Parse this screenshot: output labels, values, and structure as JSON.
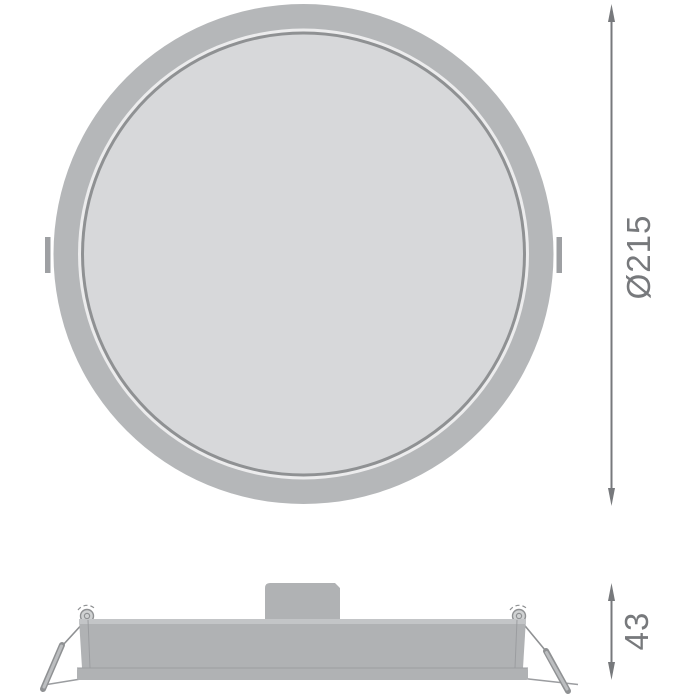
{
  "drawing": {
    "dimensions": {
      "diameter": {
        "label": "Ø215"
      },
      "height": {
        "label": "43"
      }
    }
  },
  "colors": {
    "background": "#ffffff",
    "bezel": "#b5b7b9",
    "gap_ring": "#ececed",
    "dark_ring": "#8f9193",
    "inner_face": "#d7d8da",
    "tab": "#9ea0a3",
    "body": "#b0b2b4",
    "body_light": "#c3c5c7",
    "edge": "#9b9da0",
    "spring": "#8f9193",
    "rod_core": "#bcbec0",
    "coil_fill": "#d0d2d3",
    "dimension": "#77797c"
  }
}
